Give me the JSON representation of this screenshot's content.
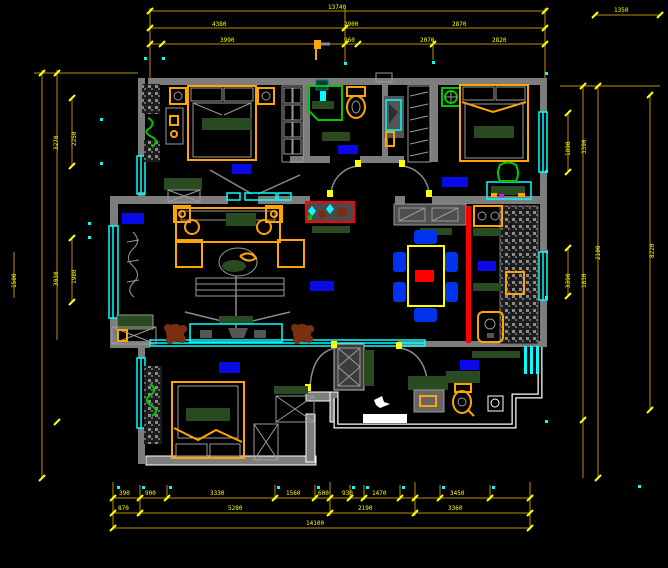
{
  "title": "apartment-floor-plan-cad-drawing",
  "colors": {
    "bg": "#000000",
    "wall": "#7d7d7d",
    "dim_line": "#b89000",
    "dim_text": "#ffff00",
    "window": "#00ffff",
    "label": "#0a0ae6",
    "accent_orange": "#ffa500",
    "dark_green": "#2a4a22",
    "bright_green": "#00c800",
    "red": "#ff0000",
    "chair_blue": "#0033ee",
    "plant_brown": "#7a3010",
    "white": "#ffffff"
  },
  "dims": {
    "top1": [
      "13740"
    ],
    "top2": [
      "4380",
      "2900",
      "2870"
    ],
    "top3": [
      "3990",
      "960",
      "2070",
      "2820"
    ],
    "top_right": [
      "1350"
    ],
    "left": [
      "3270",
      "2250",
      "3030",
      "1980",
      "1500"
    ],
    "right": [
      "1890",
      "3390",
      "2100",
      "3390",
      "1830",
      "8220"
    ],
    "bottom1": [
      "390",
      "900",
      "3330",
      "1560",
      "600",
      "930",
      "1470",
      "3450"
    ],
    "bottom2": [
      "870",
      "5280",
      "2190",
      "3360"
    ],
    "bottom3": [
      "14100"
    ]
  }
}
